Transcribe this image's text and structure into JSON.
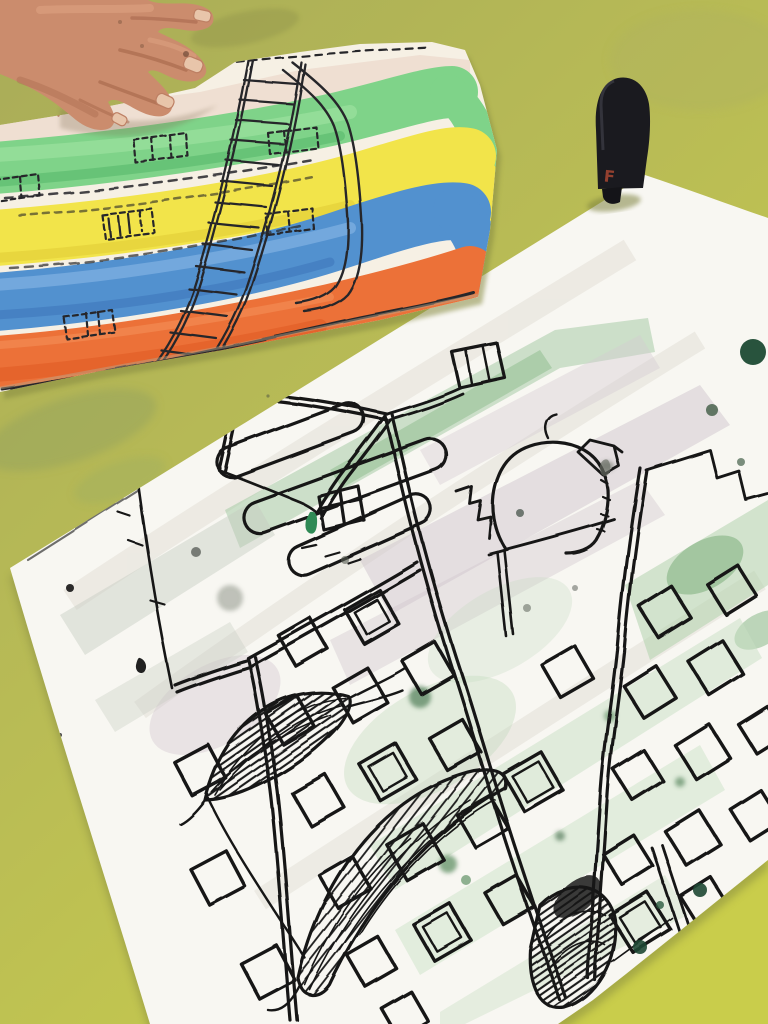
{
  "scene": {
    "description": "Overhead photo of two children's watercolor-and-ink drawings lying on an olive-green table, with a child's hand resting on the striped painting and a black marker cap beside the large city drawing"
  },
  "table": {
    "color_top": "#a9ac58",
    "color_mid": "#b9bc55",
    "color_bottom": "#c9cd4b"
  },
  "hand": {
    "skin_color": "#cb8c6d",
    "shadow_color": "#a5654a",
    "nail_color": "#e8c5aa"
  },
  "rainbow_painting": {
    "paper_color": "#f6f0e4",
    "ink_color": "#26262a",
    "stripe_colors": {
      "pink": "#ecd9cc",
      "green": "#7fd389",
      "yellow": "#f2e44a",
      "blue": "#5291cf",
      "orange": "#ec7138"
    },
    "motifs": "building facade with dashed windows and a long fire-escape ladder over rainbow stripes"
  },
  "marker_cap": {
    "letter": "F",
    "letter_color": "#93402f",
    "body_color": "#1a1a1f"
  },
  "city_drawing": {
    "paper_color": "#f8f7f2",
    "ink_color": "#161616",
    "wash_colors": {
      "green": "#9fc89f",
      "gray": "#cfc5cd",
      "pale_green": "#c8dfc3",
      "right_green": "#abd0a8"
    },
    "splatter_color": "#1c4a33",
    "motifs": "apartment blocks with square windows, gable roof house, dome tower, pole with box, outlined clouds, hatched leaf shapes, green paint splatters"
  }
}
